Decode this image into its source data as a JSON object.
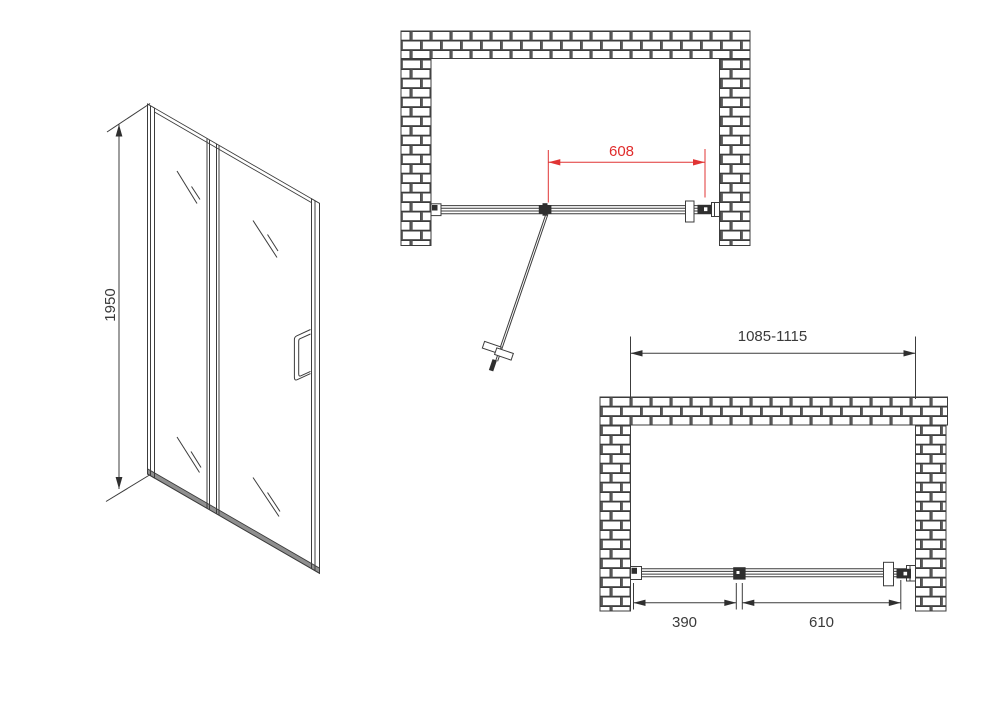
{
  "drawing": {
    "front_view": {
      "height_label": "1950"
    },
    "plan_open_view": {
      "opening_label": "608"
    },
    "plan_closed_view": {
      "overall_width_label": "1085-1115",
      "fixed_panel_label": "390",
      "door_panel_label": "610"
    },
    "colors": {
      "line": "#3c3c3c",
      "dimension_accent": "#e03434",
      "text": "#3a3a3a"
    }
  }
}
